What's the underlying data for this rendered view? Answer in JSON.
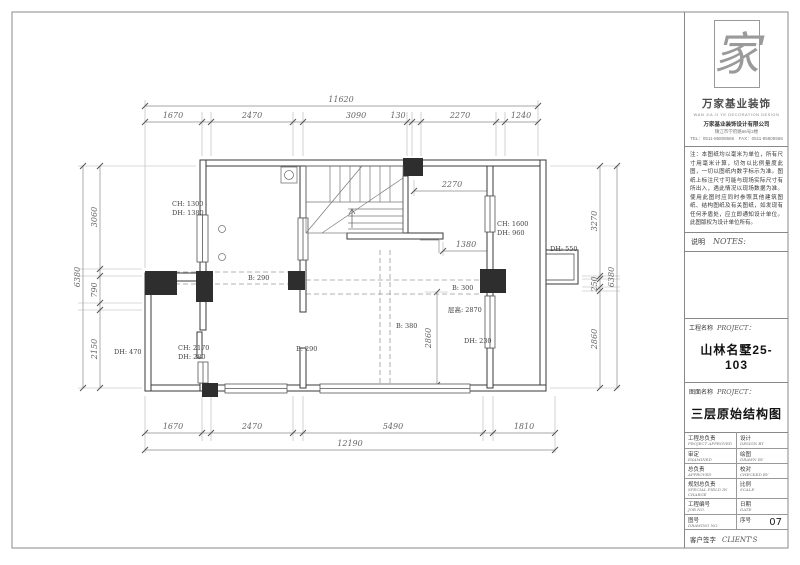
{
  "titleblock": {
    "logo_char": "家",
    "brand_name": "万家基业装饰",
    "brand_tagline": "WAN JIA JI YE DECORATION DESIGN",
    "company_name": "万家基业装饰设计有限公司",
    "company_address": "镇江市学府路66号2楼",
    "company_phone": "TEL：0511-85808666　FAX：0511-85808666",
    "notes_body": "注：本图纸均以毫米为单位，所有尺寸用毫米计算，切勿以比例量度此图，一切以图纸内数字标示为准。图纸上标注尺寸可能与现场实际尺寸有所出入，遇此情况以现场数据为准。使用此图时应同时参照其他建筑图纸、结构图纸及有关图纸，如发现有任何矛盾处，应立即通知设计单位。此图版权为设计单位所有。",
    "notes_title_cn": "说明",
    "notes_title_en": "NOTES:",
    "project_label_cn": "工程名称",
    "project_label_en": "PROJECT：",
    "project_value": "山林名墅25-103",
    "drawing_label_cn": "图面名称",
    "drawing_label_en": "PROJECT：",
    "drawing_value": "三层原始结构图",
    "table_rows": [
      {
        "left_cn": "工程总负责",
        "left_en": "PROJECT APPROVED",
        "right_cn": "设计",
        "right_en": "DESIGN BY"
      },
      {
        "left_cn": "审定",
        "left_en": "EXAMINED",
        "right_cn": "绘图",
        "right_en": "DRAWN BY"
      },
      {
        "left_cn": "总负责",
        "left_en": "APPROVED",
        "right_cn": "校对",
        "right_en": "CHECKED BY"
      },
      {
        "left_cn": "规划总负责",
        "left_en": "SPECIAL FIELD IN CHARGE",
        "right_cn": "比例",
        "right_en": "SCALE"
      },
      {
        "left_cn": "工程编号",
        "left_en": "JOB NO.",
        "right_cn": "日期",
        "right_en": "DATE"
      },
      {
        "left_cn": "图号",
        "left_en": "DRAWING NO.",
        "right_cn": "序号",
        "right_en": ""
      }
    ],
    "serial_no": "07",
    "client_cn": "客户签字",
    "client_en": "CLIENT'S"
  },
  "plan": {
    "dims_top_overall": "11620",
    "dims_top": [
      "1670",
      "2470",
      "3090",
      "130",
      "2270",
      "1240"
    ],
    "dims_bottom": [
      "1670",
      "2470",
      "5490",
      "1810"
    ],
    "dims_bottom_overall": "12190",
    "dims_left": [
      "3060",
      "790",
      "2150"
    ],
    "dims_left_overall": "6380",
    "dims_right": [
      "3270",
      "250",
      "2860"
    ],
    "dims_right_overall": "6380",
    "dims_inner": {
      "a": "2270",
      "b": "1380",
      "c": "2860"
    },
    "labels": {
      "ch1300": "CH: 1300",
      "dh1380": "DH: 1380",
      "dh470": "DH: 470",
      "ch2170": "CH: 2170",
      "dh280": "DH: 280",
      "b290a": "B: 290",
      "b290b": "B: 290",
      "b300": "B: 300",
      "b380": "B: 380",
      "cenggao": "层高: 2870",
      "dh230": "DH: 230",
      "ch1600": "CH: 1600",
      "dh960": "DH: 960",
      "dh550": "DH: 550"
    }
  }
}
